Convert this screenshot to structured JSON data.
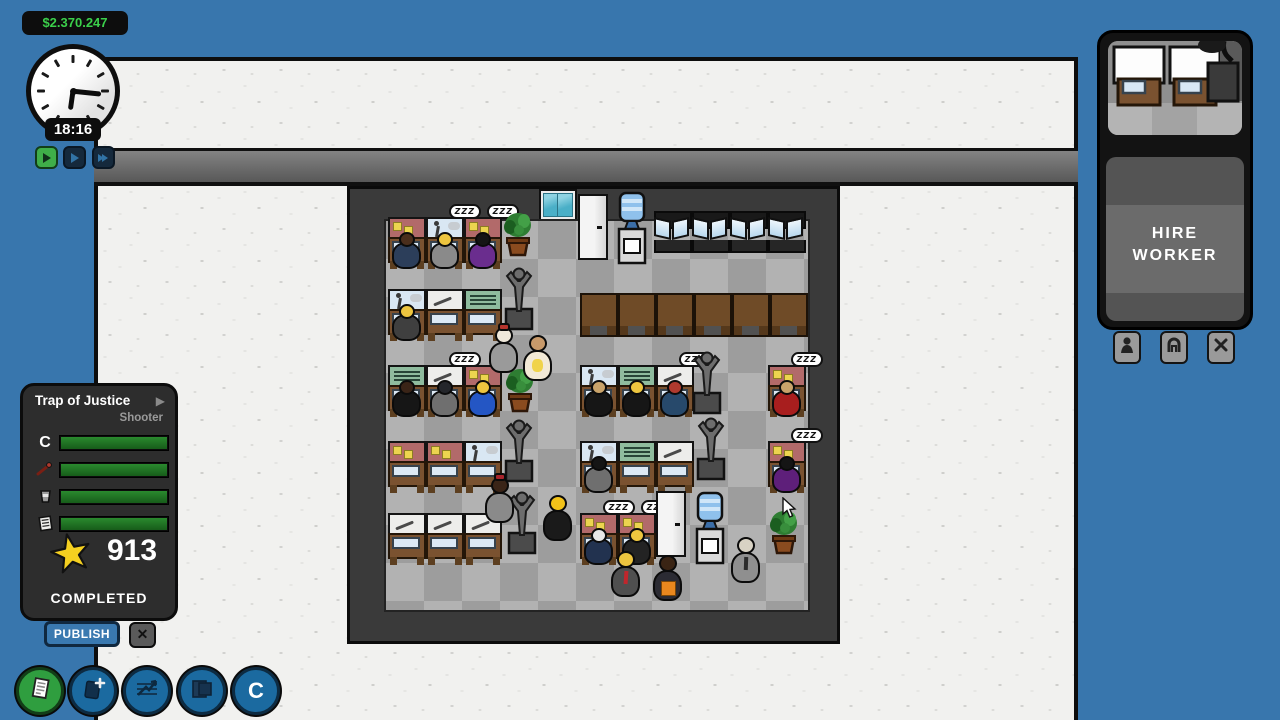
{
  "hud": {
    "money": "$2.370.247",
    "time": "18:16",
    "speed_buttons": [
      {
        "name": "play-speed-1"
      },
      {
        "name": "play-speed-2"
      },
      {
        "name": "fast-forward"
      }
    ],
    "cursor": {
      "x": 781,
      "y": 497
    }
  },
  "project_panel": {
    "title": "Trap of Justice",
    "genre": "Shooter",
    "expand_arrow": "▶",
    "bars": [
      {
        "name": "code",
        "label": "C",
        "value": 100
      },
      {
        "name": "art",
        "label": "",
        "value": 100
      },
      {
        "name": "sound",
        "label": "",
        "value": 100
      },
      {
        "name": "writing",
        "label": "",
        "value": 100
      }
    ],
    "score": "913",
    "status": "COMPLETED",
    "publish_label": "PUBLISH",
    "close_label": "✕"
  },
  "toolbar": {
    "buttons": [
      {
        "name": "reports"
      },
      {
        "name": "new-project"
      },
      {
        "name": "statistics"
      },
      {
        "name": "rooms"
      },
      {
        "name": "company",
        "label": "C"
      }
    ]
  },
  "hire_panel": {
    "label_line1": "HIRE",
    "label_line2": "WORKER",
    "tabs": [
      {
        "name": "worker-tab"
      },
      {
        "name": "furniture-tab"
      },
      {
        "name": "close-tab",
        "label": "✕"
      }
    ]
  },
  "colors": {
    "background_blue": "#3876ad",
    "money_green": "#3bd04b",
    "bar_green": "#1d6d20",
    "panel_dark": "#2d2d2d",
    "floor_light": "#b2b2b2",
    "floor_dark": "#9d9d9d"
  },
  "scene": {
    "zzz_text": "ZZZ",
    "objects": [
      {
        "t": "desk",
        "x": 38,
        "y": 28,
        "v": "red",
        "h": "#4a2e1c",
        "b": "#2c3e5a"
      },
      {
        "t": "desk",
        "x": 76,
        "y": 28,
        "v": "blue",
        "h": "#edc53f",
        "b": "#8a8a8a",
        "z": 1
      },
      {
        "t": "desk",
        "x": 114,
        "y": 28,
        "v": "red",
        "h": "#151515",
        "b": "#6a2d8e",
        "z": 1
      },
      {
        "t": "plant",
        "x": 150,
        "y": 22
      },
      {
        "t": "fridge",
        "x": 228,
        "y": 5
      },
      {
        "t": "cooler",
        "x": 266,
        "y": 2
      },
      {
        "t": "mdesk",
        "x": 304,
        "y": 22
      },
      {
        "t": "mdesk",
        "x": 342,
        "y": 22
      },
      {
        "t": "mdesk",
        "x": 380,
        "y": 22
      },
      {
        "t": "mdesk",
        "x": 418,
        "y": 22
      },
      {
        "t": "statue",
        "x": 152,
        "y": 76
      },
      {
        "t": "desk",
        "x": 38,
        "y": 100,
        "v": "blue",
        "h": "#edc53f",
        "b": "#3f3f3f"
      },
      {
        "t": "desk",
        "x": 76,
        "y": 100,
        "v": "white"
      },
      {
        "t": "desk",
        "x": 114,
        "y": 100,
        "v": "green"
      },
      {
        "t": "tdesk",
        "x": 230,
        "y": 104
      },
      {
        "t": "tdesk",
        "x": 268,
        "y": 104
      },
      {
        "t": "tdesk",
        "x": 306,
        "y": 104
      },
      {
        "t": "tdesk",
        "x": 344,
        "y": 104
      },
      {
        "t": "tdesk",
        "x": 382,
        "y": 104
      },
      {
        "t": "tdesk",
        "x": 420,
        "y": 104
      },
      {
        "t": "person",
        "x": 138,
        "y": 138,
        "h": "#efe8da",
        "b": "#9a9a9a",
        "hat": "#b5342c"
      },
      {
        "t": "person",
        "x": 172,
        "y": 146,
        "h": "#c89a6b",
        "b": "#f2e9d6",
        "acc": "yellow"
      },
      {
        "t": "desk",
        "x": 38,
        "y": 176,
        "v": "green",
        "h": "#3a2417",
        "b": "#161616"
      },
      {
        "t": "desk",
        "x": 76,
        "y": 176,
        "v": "white",
        "h": "#24262b",
        "b": "#6f6f6f",
        "z": 1
      },
      {
        "t": "desk",
        "x": 114,
        "y": 176,
        "v": "red",
        "h": "#edc53f",
        "b": "#2456c4"
      },
      {
        "t": "plant",
        "x": 152,
        "y": 178
      },
      {
        "t": "desk",
        "x": 230,
        "y": 176,
        "v": "blue",
        "h": "#c9a36a",
        "b": "#161616"
      },
      {
        "t": "desk",
        "x": 268,
        "y": 176,
        "v": "green",
        "h": "#edc53f",
        "b": "#161616"
      },
      {
        "t": "desk",
        "x": 306,
        "y": 176,
        "v": "white",
        "h": "#b03a2e",
        "b": "#27496b",
        "z": 1
      },
      {
        "t": "statue",
        "x": 340,
        "y": 160
      },
      {
        "t": "desk",
        "x": 418,
        "y": 176,
        "v": "red",
        "h": "#c9a36a",
        "b": "#a81e1e",
        "z": 1
      },
      {
        "t": "statue",
        "x": 152,
        "y": 228
      },
      {
        "t": "desk",
        "x": 38,
        "y": 252,
        "v": "red"
      },
      {
        "t": "desk",
        "x": 76,
        "y": 252,
        "v": "red"
      },
      {
        "t": "desk",
        "x": 114,
        "y": 252,
        "v": "blue"
      },
      {
        "t": "desk",
        "x": 230,
        "y": 252,
        "v": "blue",
        "h": "#151515",
        "b": "#6f6f6f"
      },
      {
        "t": "desk",
        "x": 268,
        "y": 252,
        "v": "green"
      },
      {
        "t": "desk",
        "x": 306,
        "y": 252,
        "v": "white"
      },
      {
        "t": "statue",
        "x": 344,
        "y": 226
      },
      {
        "t": "desk",
        "x": 418,
        "y": 252,
        "v": "red",
        "h": "#151515",
        "b": "#5e1f7a",
        "z": 1
      },
      {
        "t": "person",
        "x": 134,
        "y": 288,
        "h": "#3a2417",
        "b": "#8a8a8a",
        "hat": "#a8242c"
      },
      {
        "t": "statue",
        "x": 155,
        "y": 300
      },
      {
        "t": "person",
        "x": 192,
        "y": 306,
        "h": "#f2c219",
        "b": "#1a1a1a"
      },
      {
        "t": "desk",
        "x": 38,
        "y": 324,
        "v": "white"
      },
      {
        "t": "desk",
        "x": 76,
        "y": 324,
        "v": "white"
      },
      {
        "t": "desk",
        "x": 114,
        "y": 324,
        "v": "white"
      },
      {
        "t": "desk",
        "x": 230,
        "y": 324,
        "v": "red",
        "h": "#e8e8e8",
        "b": "#22324f",
        "z": 1
      },
      {
        "t": "desk",
        "x": 268,
        "y": 324,
        "v": "red",
        "h": "#edc53f",
        "b": "#232323",
        "z": 1
      },
      {
        "t": "fridge",
        "x": 306,
        "y": 302
      },
      {
        "t": "cooler",
        "x": 344,
        "y": 302
      },
      {
        "t": "plant",
        "x": 416,
        "y": 320
      },
      {
        "t": "person",
        "x": 380,
        "y": 348,
        "h": "#d8d2c4",
        "b": "#8f8f8f",
        "acc": "tie-dark"
      },
      {
        "t": "person",
        "x": 260,
        "y": 362,
        "h": "#edc53f",
        "b": "#4f4f4f",
        "acc": "tie-red"
      },
      {
        "t": "person",
        "x": 302,
        "y": 366,
        "h": "#3a2414",
        "b": "#2b2b33",
        "acc": "orange"
      }
    ]
  }
}
